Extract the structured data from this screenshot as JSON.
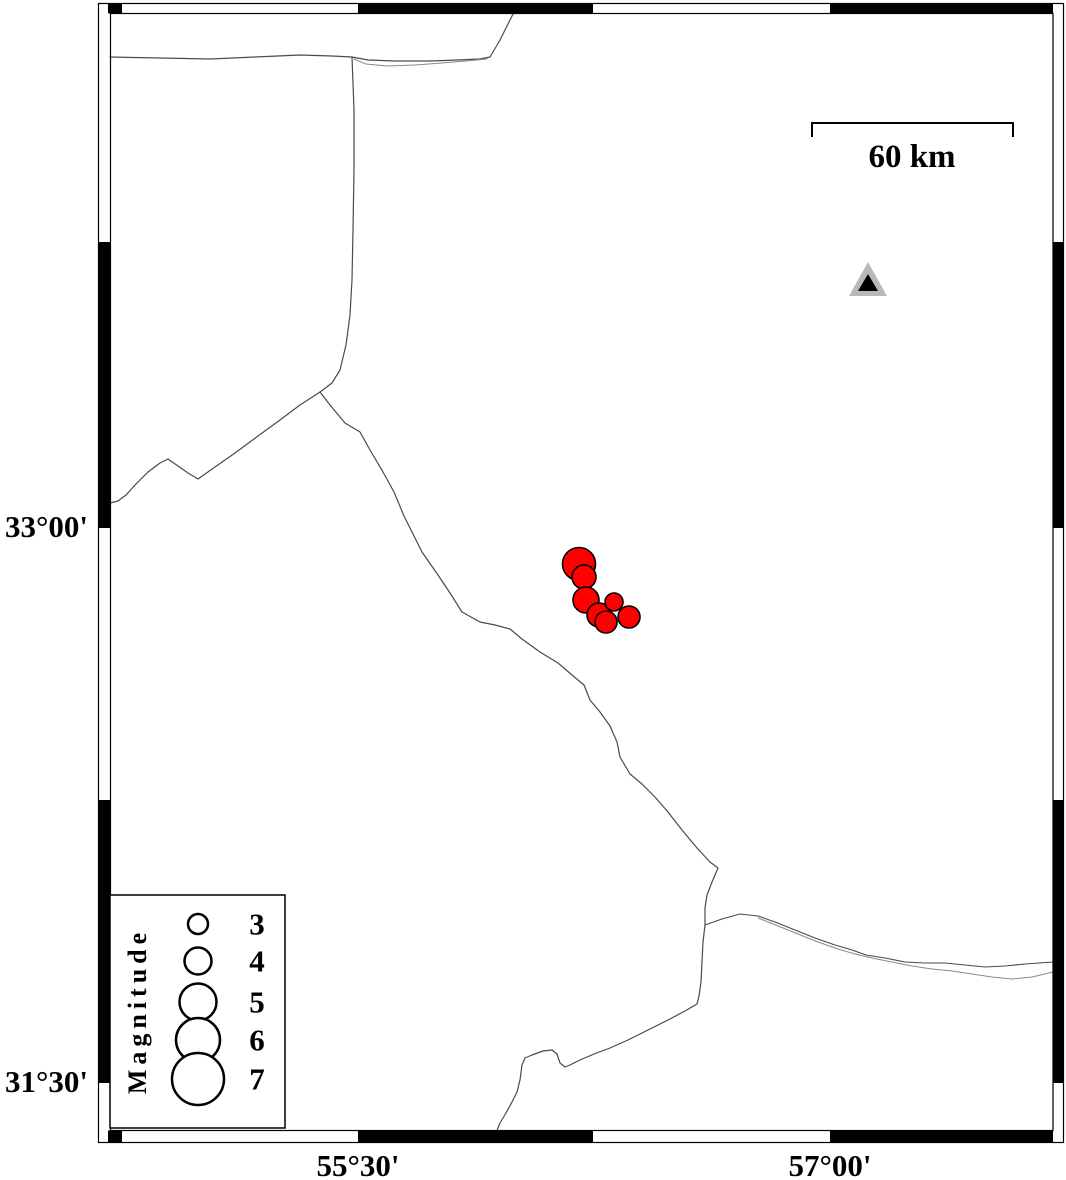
{
  "figure_type": "seismicity-map",
  "colors": {
    "background": "#ffffff",
    "frame_black": "#000000",
    "boundary_line": "#4a4a4a",
    "boundary_line_faint": "#8a8a8a",
    "earthquake_fill": "#ff0000",
    "earthquake_outline": "#000000",
    "station_outer": "#b9b9b9",
    "station_inner": "#000000"
  },
  "axes": {
    "left": [
      {
        "text": "33°00'",
        "y": 537
      },
      {
        "text": "31°30'",
        "y": 1092
      }
    ],
    "bottom": [
      {
        "text": "55°30'",
        "x": 358
      },
      {
        "text": "57°00'",
        "x": 830
      }
    ]
  },
  "scale_bar": {
    "label": "60 km",
    "path_d": "M 812,137 L 812,123 L 1013,123 L 1013,137",
    "label_x": 912,
    "label_y": 167
  },
  "legend": {
    "title": "Magnitude",
    "box": {
      "x": 110,
      "y": 895,
      "w": 175,
      "h": 233
    },
    "circle_cx": 198,
    "label_x": 257,
    "items": [
      {
        "label": "3",
        "cy": 924,
        "r": 10
      },
      {
        "label": "4",
        "cy": 961,
        "r": 13.5
      },
      {
        "label": "5",
        "cy": 1002,
        "r": 18.5
      },
      {
        "label": "6",
        "cy": 1040,
        "r": 22
      },
      {
        "label": "7",
        "cy": 1079,
        "r": 26
      }
    ]
  },
  "station": {
    "outer_points": "868,262 887,296 849,296",
    "inner_points": "868,274 878,291 858,291"
  },
  "earthquakes": [
    {
      "cx": 579,
      "cy": 564,
      "r": 16.5
    },
    {
      "cx": 584,
      "cy": 577,
      "r": 12
    },
    {
      "cx": 586,
      "cy": 600,
      "r": 13
    },
    {
      "cx": 599,
      "cy": 615,
      "r": 12
    },
    {
      "cx": 606,
      "cy": 622,
      "r": 11
    },
    {
      "cx": 614,
      "cy": 602,
      "r": 9
    },
    {
      "cx": 629,
      "cy": 617,
      "r": 11
    }
  ],
  "boundaries": [
    {
      "name": "north-boundary",
      "width": 1.2,
      "faint": false,
      "points": "110,57 160,58 210,59 255,57 300,55 332,56 352,57 368,60 395,61 430,61 458,60 480,59 490,57 500,40 507,26 513,14"
    },
    {
      "name": "north-boundary-parallel",
      "width": 1,
      "faint": true,
      "points": "354,59 366,64 388,66 415,65 442,63 466,61 487,59"
    },
    {
      "name": "west-vertical-boundary",
      "width": 1.2,
      "faint": false,
      "points": "352,57 354,110 354,170 353,230 352,280 350,315 346,345 340,370 332,383 320,392"
    },
    {
      "name": "west-branch-boundary",
      "width": 1.2,
      "faint": false,
      "points": "110,503 118,501 126,495 136,484 148,472 160,463 168,459 178,466 188,473 198,479 215,467 235,453 258,436 280,420 300,405 320,392"
    },
    {
      "name": "central-boundary",
      "width": 1.2,
      "faint": false,
      "points": "320,392 330,405 345,423 360,432 370,450 383,472 394,492 404,516 415,538 422,552 438,575 450,593 462,612 480,622 495,625 510,629 522,639 540,652 558,663 572,675 584,685 590,700 600,712 610,726 617,742 620,757 630,774 642,784 655,797 668,812 682,830 697,848 710,862 718,868 712,882 707,895 705,908 705,925 703,942 702,962 701,982 699,996 697,1004 685,1011 668,1020 648,1030 628,1040 610,1048 594,1054 580,1060 570,1065 565,1067 560,1063 557,1054 552,1050 543,1051 532,1055 525,1058 522,1065 520,1080 517,1092 512,1102 506,1113 500,1123 496,1133"
    },
    {
      "name": "southeast-boundary-upper",
      "width": 1.1,
      "faint": false,
      "points": "705,925 722,919 740,914 758,916 775,922 795,930 815,938 835,945 852,950 866,955 885,958 905,962 925,963 945,963 965,965 985,967 1005,966 1025,964 1053,962"
    },
    {
      "name": "southeast-boundary-lower",
      "width": 1,
      "faint": true,
      "points": "758,918 778,926 798,934 818,942 838,949 855,954 872,958 892,962 912,966 932,969 952,971 972,974 992,977 1012,979 1032,977 1053,972"
    }
  ],
  "frame": {
    "outer": {
      "x": 98.5,
      "y": 3.5,
      "w": 965,
      "h": 1139
    },
    "inner": {
      "x": 110.5,
      "y": 13.5,
      "w": 942.5,
      "h": 1117
    },
    "black_segments": [
      {
        "x": 108,
        "y": 4,
        "w": 14,
        "h": 9.5
      },
      {
        "x": 358,
        "y": 4,
        "w": 235,
        "h": 9.5
      },
      {
        "x": 830,
        "y": 4,
        "w": 223,
        "h": 9.5
      },
      {
        "x": 108,
        "y": 1130.5,
        "w": 14,
        "h": 11.5
      },
      {
        "x": 358,
        "y": 1130.5,
        "w": 235,
        "h": 11.5
      },
      {
        "x": 830,
        "y": 1130.5,
        "w": 223,
        "h": 11.5
      },
      {
        "x": 98.5,
        "y": 242,
        "w": 12,
        "h": 286
      },
      {
        "x": 98.5,
        "y": 800,
        "w": 12,
        "h": 283
      },
      {
        "x": 1053,
        "y": 242,
        "w": 11,
        "h": 286
      },
      {
        "x": 1053,
        "y": 800,
        "w": 11,
        "h": 283
      }
    ]
  }
}
